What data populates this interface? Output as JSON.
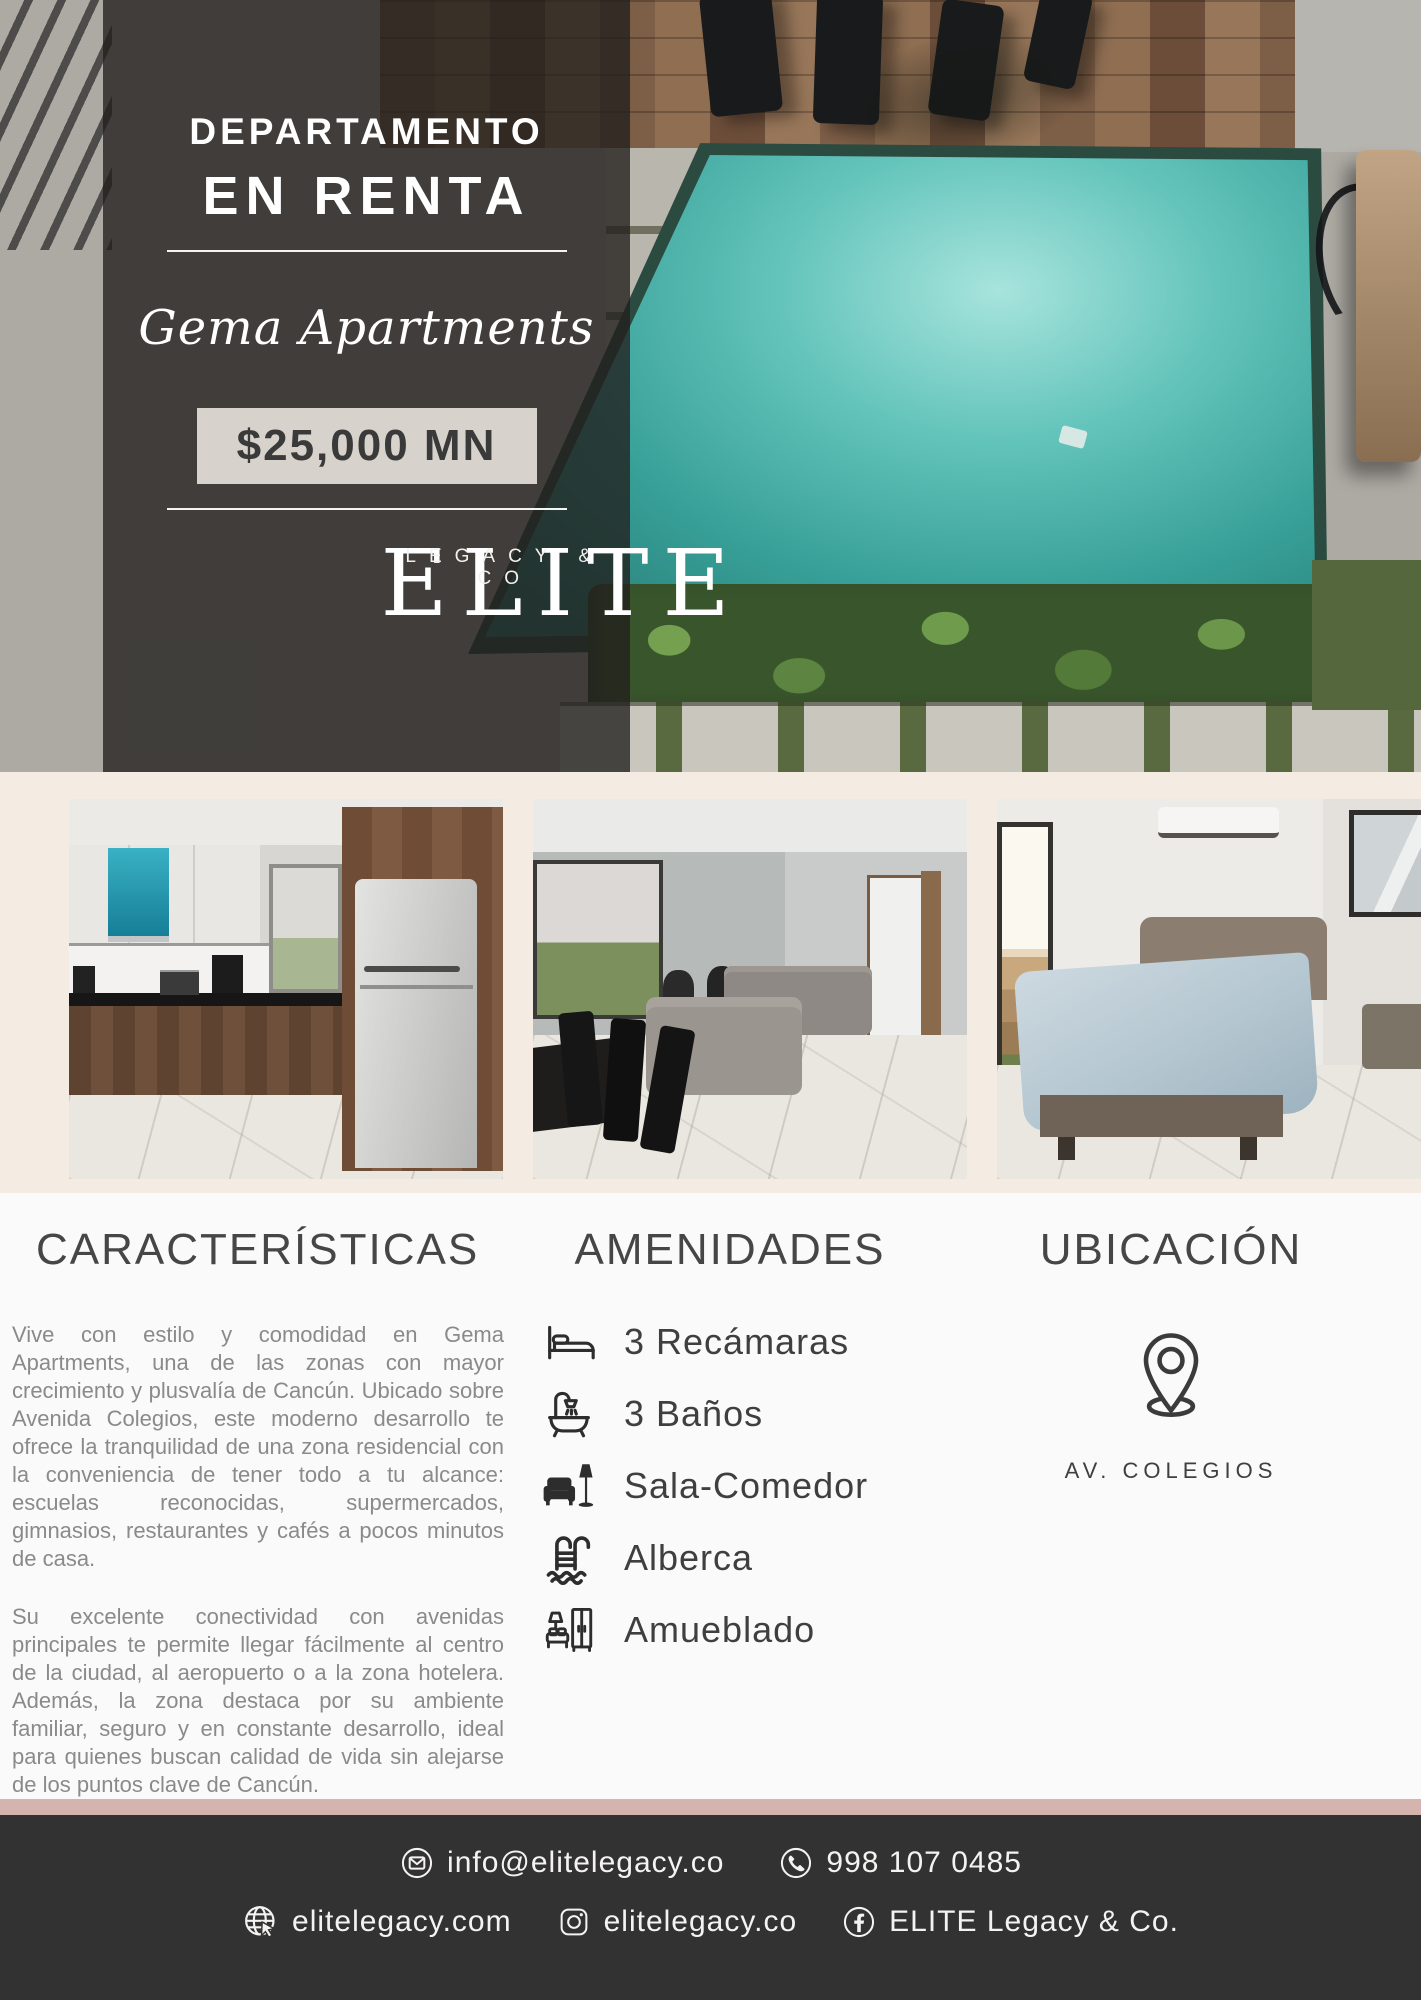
{
  "hero": {
    "category": "DEPARTAMENTO",
    "status": "EN RENTA",
    "property_name": "Gema Apartments",
    "price": "$25,000 MN",
    "brand": {
      "name": "ELITE",
      "tagline": "LEGACY & CO"
    }
  },
  "characteristics": {
    "heading": "CARACTERÍSTICAS",
    "paragraphs": [
      "Vive con estilo y comodidad en Gema Apartments, una de las zonas con mayor crecimiento y plusvalía de Cancún. Ubicado sobre Avenida Colegios, este moderno desarrollo te ofrece la tranquilidad de una zona residencial con la conveniencia de tener todo a tu alcance: escuelas reconocidas, supermercados, gimnasios, restaurantes y cafés a pocos minutos de casa.",
      "Su excelente conectividad con avenidas principales te permite llegar fácilmente al centro de la ciudad, al aeropuerto o a la zona hotelera. Además, la zona destaca por su ambiente familiar, seguro y en constante desarrollo, ideal para quienes buscan calidad de vida sin alejarse de los puntos clave de Cancún."
    ],
    "note": "Incluye Internet. PB"
  },
  "amenities": {
    "heading": "AMENIDADES",
    "items": [
      {
        "icon": "bed-icon",
        "label": "3 Recámaras"
      },
      {
        "icon": "bathtub-icon",
        "label": "3 Baños"
      },
      {
        "icon": "armchair-lamp-icon",
        "label": "Sala-Comedor"
      },
      {
        "icon": "pool-ladder-icon",
        "label": "Alberca"
      },
      {
        "icon": "furniture-icon",
        "label": "Amueblado"
      }
    ]
  },
  "location": {
    "heading": "UBICACIÓN",
    "icon": "location-pin-icon",
    "address": "AV. COLEGIOS"
  },
  "footer": {
    "email": "info@elitelegacy.co",
    "phone": "998 107 0485",
    "website": "elitelegacy.com",
    "instagram": "elitelegacy.co",
    "facebook": "ELITE Legacy & Co."
  },
  "theme": {
    "accent_pink": "#d5b4af",
    "cream_band": "#f4ebe2",
    "footer_bg": "#333233",
    "overlay_panel": "rgba(33,31,28,0.78)",
    "pool_teal": "#379f97",
    "heading_gray": "#464646",
    "body_gray": "#8a8a8a"
  }
}
